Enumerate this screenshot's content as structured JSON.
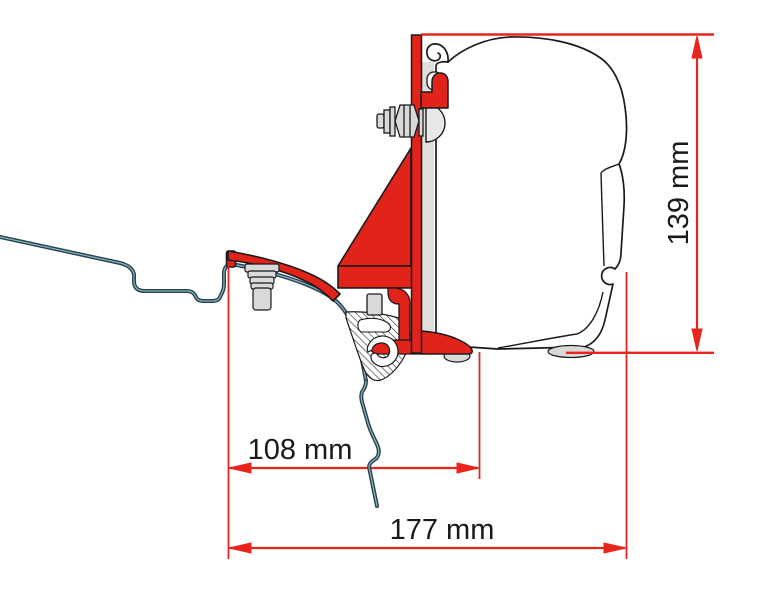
{
  "diagram": {
    "labels": {
      "dim_108": "108 mm",
      "dim_177": "177 mm",
      "dim_139": "139 mm"
    },
    "colors": {
      "bracket_red": "#e2231a",
      "dimension_red": "#e8241c",
      "profile_dark": "#24424f",
      "profile_core": "#8fb3bd",
      "metal_gray": "#d9d9d9",
      "outline_black": "#1a1a1a"
    }
  }
}
